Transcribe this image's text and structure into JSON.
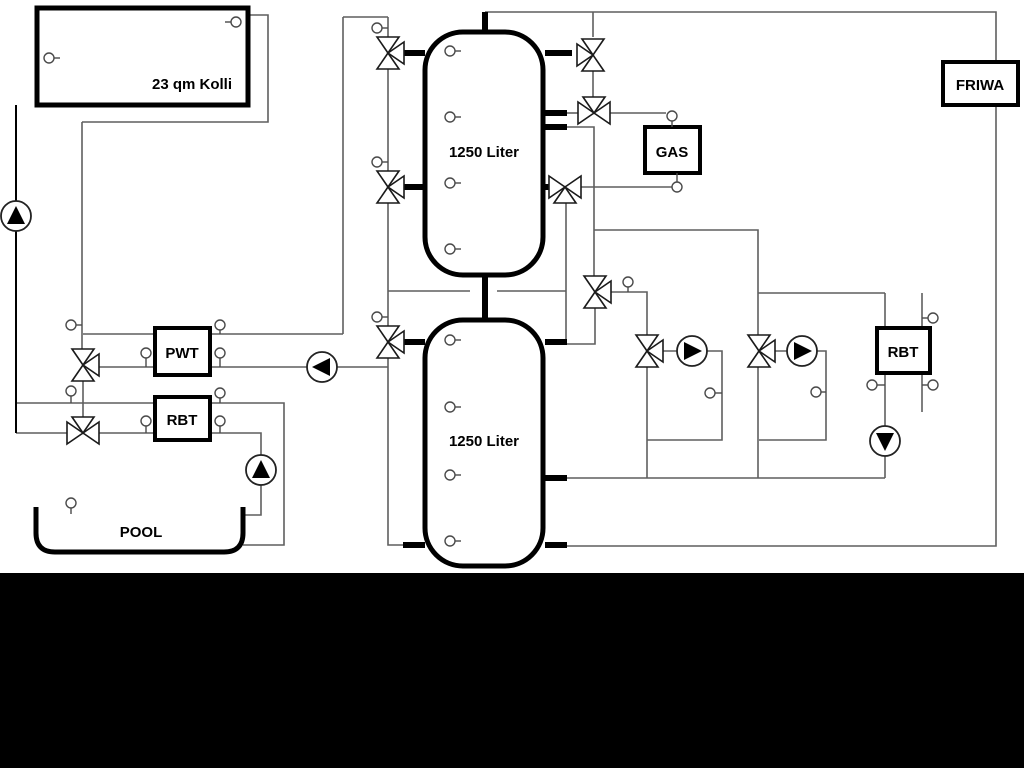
{
  "canvas": {
    "width": 1024,
    "height": 768,
    "background": "#ffffff"
  },
  "colors": {
    "line": "#5f5f5f",
    "black": "#000000",
    "fill": "#ffffff",
    "sensor": "#4a4a4a"
  },
  "bottom_bar": {
    "x": 0,
    "y": 573,
    "width": 1024,
    "height": 195,
    "color": "#000000"
  },
  "boxes": [
    {
      "name": "collector",
      "label": "23 qm Kolli",
      "x": 37,
      "y": 8,
      "w": 211,
      "h": 97,
      "sw": 5,
      "lx": 192,
      "ly": 89
    },
    {
      "name": "pwt",
      "label": "PWT",
      "x": 155,
      "y": 328,
      "w": 55,
      "h": 47,
      "sw": 4,
      "lx": 182,
      "ly": 358
    },
    {
      "name": "rbt-left",
      "label": "RBT",
      "x": 155,
      "y": 397,
      "w": 55,
      "h": 43,
      "sw": 4,
      "lx": 182,
      "ly": 425
    },
    {
      "name": "gas",
      "label": "GAS",
      "x": 645,
      "y": 127,
      "w": 55,
      "h": 46,
      "sw": 4,
      "lx": 672,
      "ly": 157
    },
    {
      "name": "friwa",
      "label": "FRIWA",
      "x": 943,
      "y": 62,
      "w": 75,
      "h": 43,
      "sw": 4,
      "lx": 980,
      "ly": 90
    },
    {
      "name": "rbt-right",
      "label": "RBT",
      "x": 877,
      "y": 328,
      "w": 53,
      "h": 45,
      "sw": 4,
      "lx": 903,
      "ly": 357
    }
  ],
  "tanks": [
    {
      "name": "buffer-tank-1",
      "label": "1250 Liter",
      "x": 425,
      "y": 32,
      "w": 118,
      "h": 243,
      "lx": 484,
      "ly": 157
    },
    {
      "name": "buffer-tank-2",
      "label": "1250 Liter",
      "x": 425,
      "y": 320,
      "w": 118,
      "h": 246,
      "lx": 484,
      "ly": 446
    }
  ],
  "pool": {
    "name": "pool",
    "label": "POOL",
    "path": "M36,507 L36,533 Q36,552 55,552 L224,552 Q243,552 243,533 L243,507",
    "lx": 141,
    "ly": 537
  },
  "pipes": [
    {
      "pts": [
        [
          485,
          12
        ],
        [
          996,
          12
        ],
        [
          996,
          62
        ]
      ]
    },
    {
      "pts": [
        [
          996,
          105
        ],
        [
          996,
          546
        ],
        [
          566,
          546
        ]
      ]
    },
    {
      "pts": [
        [
          566,
          478
        ],
        [
          885,
          478
        ]
      ]
    },
    {
      "pts": [
        [
          885,
          293
        ],
        [
          885,
          328
        ]
      ]
    },
    {
      "pts": [
        [
          885,
          372
        ],
        [
          885,
          478
        ]
      ]
    },
    {
      "pts": [
        [
          758,
          293
        ],
        [
          885,
          293
        ]
      ]
    },
    {
      "pts": [
        [
          594,
          230
        ],
        [
          758,
          230
        ],
        [
          758,
          335
        ]
      ]
    },
    {
      "pts": [
        [
          758,
          367
        ],
        [
          758,
          478
        ]
      ]
    },
    {
      "pts": [
        [
          775,
          351
        ],
        [
          826,
          351
        ],
        [
          826,
          440
        ],
        [
          759,
          440
        ]
      ]
    },
    {
      "pts": [
        [
          611,
          292
        ],
        [
          647,
          292
        ],
        [
          647,
          335
        ]
      ]
    },
    {
      "pts": [
        [
          647,
          367
        ],
        [
          647,
          478
        ]
      ]
    },
    {
      "pts": [
        [
          663,
          351
        ],
        [
          722,
          351
        ],
        [
          722,
          440
        ],
        [
          647,
          440
        ]
      ]
    },
    {
      "pts": [
        [
          566,
          127
        ],
        [
          594,
          127
        ],
        [
          594,
          276
        ]
      ]
    },
    {
      "pts": [
        [
          595,
          308
        ],
        [
          595,
          344
        ],
        [
          566,
          344
        ]
      ]
    },
    {
      "pts": [
        [
          566,
          203
        ],
        [
          566,
          342
        ]
      ]
    },
    {
      "pts": [
        [
          388,
          291
        ],
        [
          470,
          291
        ]
      ]
    },
    {
      "pts": [
        [
          497,
          291
        ],
        [
          566,
          291
        ]
      ]
    },
    {
      "pts": [
        [
          593,
          12
        ],
        [
          593,
          37
        ]
      ]
    },
    {
      "pts": [
        [
          593,
          71
        ],
        [
          593,
          97
        ]
      ]
    },
    {
      "pts": [
        [
          610,
          113
        ],
        [
          666,
          113
        ]
      ]
    },
    {
      "pts": [
        [
          580,
          187
        ],
        [
          672,
          187
        ]
      ]
    },
    {
      "pts": [
        [
          922,
          293
        ],
        [
          922,
          412
        ]
      ]
    },
    {
      "pts": [
        [
          343,
          17
        ],
        [
          388,
          17
        ]
      ]
    },
    {
      "pts": [
        [
          343,
          17
        ],
        [
          343,
          334
        ]
      ]
    },
    {
      "pts": [
        [
          83,
          334
        ],
        [
          155,
          334
        ]
      ]
    },
    {
      "pts": [
        [
          210,
          334
        ],
        [
          343,
          334
        ]
      ]
    },
    {
      "pts": [
        [
          99,
          367
        ],
        [
          155,
          367
        ]
      ]
    },
    {
      "pts": [
        [
          210,
          367
        ],
        [
          388,
          367
        ]
      ]
    },
    {
      "pts": [
        [
          388,
          17
        ],
        [
          388,
          37
        ]
      ]
    },
    {
      "pts": [
        [
          388,
          69
        ],
        [
          388,
          171
        ]
      ]
    },
    {
      "pts": [
        [
          388,
          203
        ],
        [
          388,
          326
        ]
      ]
    },
    {
      "pts": [
        [
          388,
          358
        ],
        [
          388,
          545
        ],
        [
          403,
          545
        ]
      ]
    },
    {
      "pts": [
        [
          82,
          122
        ],
        [
          82,
          349
        ]
      ]
    },
    {
      "pts": [
        [
          83,
          381
        ],
        [
          83,
          417
        ]
      ]
    },
    {
      "pts": [
        [
          16,
          403
        ],
        [
          155,
          403
        ]
      ]
    },
    {
      "pts": [
        [
          210,
          403
        ],
        [
          284,
          403
        ],
        [
          284,
          545
        ],
        [
          243,
          545
        ]
      ]
    },
    {
      "pts": [
        [
          16,
          433
        ],
        [
          67,
          433
        ]
      ]
    },
    {
      "pts": [
        [
          99,
          433
        ],
        [
          155,
          433
        ]
      ]
    },
    {
      "pts": [
        [
          210,
          433
        ],
        [
          261,
          433
        ],
        [
          261,
          515
        ],
        [
          243,
          515
        ]
      ]
    },
    {
      "pts": [
        [
          566,
          113
        ],
        [
          578,
          113
        ]
      ]
    },
    {
      "pts": [
        [
          16,
          105
        ],
        [
          16,
          433
        ]
      ],
      "color": "#000000",
      "w": 2
    },
    {
      "pts": [
        [
          248,
          15
        ],
        [
          268,
          15
        ],
        [
          268,
          122
        ],
        [
          82,
          122
        ]
      ]
    }
  ],
  "stubs": [
    [
      485,
      12,
      485,
      34
    ],
    [
      485,
      275,
      485,
      322
    ],
    [
      545,
      53,
      572,
      53
    ],
    [
      545,
      113,
      567,
      113
    ],
    [
      545,
      127,
      567,
      127
    ],
    [
      545,
      187,
      550,
      187
    ],
    [
      404,
      53,
      425,
      53
    ],
    [
      404,
      187,
      425,
      187
    ],
    [
      404,
      342,
      425,
      342
    ],
    [
      545,
      342,
      567,
      342
    ],
    [
      545,
      478,
      567,
      478
    ],
    [
      545,
      545,
      567,
      545
    ],
    [
      403,
      545,
      425,
      545
    ]
  ],
  "valves": [
    {
      "x": 388,
      "y": 53,
      "tris": [
        "t",
        "b",
        "r"
      ]
    },
    {
      "x": 388,
      "y": 187,
      "tris": [
        "t",
        "b",
        "r"
      ]
    },
    {
      "x": 388,
      "y": 342,
      "tris": [
        "t",
        "b",
        "r"
      ]
    },
    {
      "x": 83,
      "y": 365,
      "tris": [
        "t",
        "b",
        "r"
      ]
    },
    {
      "x": 83,
      "y": 433,
      "tris": [
        "l",
        "r",
        "t"
      ]
    },
    {
      "x": 593,
      "y": 55,
      "tris": [
        "t",
        "b",
        "l"
      ]
    },
    {
      "x": 594,
      "y": 113,
      "tris": [
        "l",
        "r",
        "t"
      ]
    },
    {
      "x": 565,
      "y": 187,
      "tris": [
        "l",
        "r",
        "b"
      ]
    },
    {
      "x": 595,
      "y": 292,
      "tris": [
        "t",
        "b",
        "r"
      ]
    },
    {
      "x": 647,
      "y": 351,
      "tris": [
        "t",
        "b",
        "r"
      ]
    },
    {
      "x": 759,
      "y": 351,
      "tris": [
        "t",
        "b",
        "r"
      ]
    }
  ],
  "pumps": [
    {
      "x": 16,
      "y": 216,
      "dir": "u"
    },
    {
      "x": 322,
      "y": 367,
      "dir": "l"
    },
    {
      "x": 261,
      "y": 470,
      "dir": "u"
    },
    {
      "x": 692,
      "y": 351,
      "dir": "r"
    },
    {
      "x": 802,
      "y": 351,
      "dir": "r"
    },
    {
      "x": 885,
      "y": 441,
      "dir": "d"
    }
  ],
  "sensors": [
    [
      49,
      58,
      "r",
      6
    ],
    [
      236,
      22,
      "l",
      6
    ],
    [
      377,
      28,
      "r",
      6
    ],
    [
      377,
      162,
      "r",
      6
    ],
    [
      377,
      317,
      "r",
      6
    ],
    [
      71,
      325,
      "r",
      6
    ],
    [
      71,
      391,
      "d",
      7
    ],
    [
      146,
      353,
      "d",
      9
    ],
    [
      220,
      353,
      "d",
      9
    ],
    [
      220,
      325,
      "d",
      4
    ],
    [
      220,
      393,
      "d",
      5
    ],
    [
      146,
      421,
      "d",
      7
    ],
    [
      220,
      421,
      "d",
      7
    ],
    [
      71,
      503,
      "d",
      6
    ],
    [
      450,
      51,
      "r",
      6
    ],
    [
      450,
      117,
      "r",
      6
    ],
    [
      450,
      183,
      "r",
      6
    ],
    [
      450,
      249,
      "r",
      6
    ],
    [
      450,
      340,
      "r",
      6
    ],
    [
      450,
      407,
      "r",
      6
    ],
    [
      450,
      475,
      "r",
      6
    ],
    [
      450,
      541,
      "r",
      6
    ],
    [
      628,
      282,
      "d",
      5
    ],
    [
      672,
      116,
      "d",
      6
    ],
    [
      677,
      187,
      "u",
      9
    ],
    [
      710,
      393,
      "r",
      7
    ],
    [
      816,
      392,
      "r",
      5
    ],
    [
      872,
      385,
      "r",
      8
    ],
    [
      933,
      318,
      "l",
      6
    ],
    [
      933,
      385,
      "l",
      6
    ]
  ]
}
